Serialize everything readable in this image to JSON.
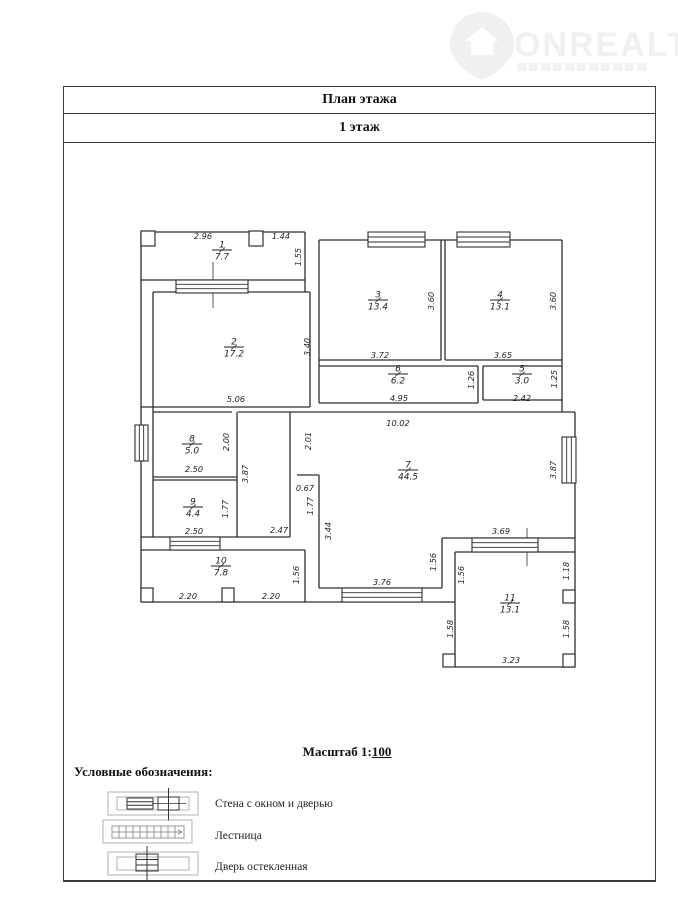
{
  "logo": {
    "brand": "ONREALT",
    "icon": "house-pin-icon"
  },
  "header": {
    "title": "План этажа",
    "subtitle": "1 этаж"
  },
  "scale": {
    "prefix": "Масштаб 1:",
    "value": "100"
  },
  "legend": {
    "title": "Условные обозначения:",
    "items": [
      {
        "symbol": "wall-with-window-and-door",
        "label": "Стена с окном и дверью"
      },
      {
        "symbol": "stairs",
        "label": "Лестница"
      },
      {
        "symbol": "glazed-door",
        "label": "Дверь остекленная"
      }
    ]
  },
  "plan": {
    "rooms": [
      {
        "num": "1",
        "area": "7.7",
        "x": 222,
        "y": 250
      },
      {
        "num": "2",
        "area": "17.2",
        "x": 234,
        "y": 347
      },
      {
        "num": "3",
        "area": "13.4",
        "x": 378,
        "y": 300
      },
      {
        "num": "4",
        "area": "13.1",
        "x": 500,
        "y": 300
      },
      {
        "num": "5",
        "area": "3.0",
        "x": 522,
        "y": 374
      },
      {
        "num": "6",
        "area": "6.2",
        "x": 398,
        "y": 374
      },
      {
        "num": "7",
        "area": "44.5",
        "x": 408,
        "y": 470
      },
      {
        "num": "8",
        "area": "5.0",
        "x": 192,
        "y": 444
      },
      {
        "num": "9",
        "area": "4.4",
        "x": 193,
        "y": 507
      },
      {
        "num": "10",
        "area": "7.8",
        "x": 221,
        "y": 566
      },
      {
        "num": "11",
        "area": "13.1",
        "x": 510,
        "y": 603
      }
    ],
    "dims_h": [
      {
        "v": "2.96",
        "x": 203,
        "y": 236
      },
      {
        "v": "1.44",
        "x": 281,
        "y": 236
      },
      {
        "v": "5.06",
        "x": 236,
        "y": 399
      },
      {
        "v": "3.72",
        "x": 380,
        "y": 355
      },
      {
        "v": "3.65",
        "x": 503,
        "y": 355
      },
      {
        "v": "4.95",
        "x": 399,
        "y": 398
      },
      {
        "v": "2.42",
        "x": 522,
        "y": 398
      },
      {
        "v": "10.02",
        "x": 398,
        "y": 423
      },
      {
        "v": "0.67",
        "x": 305,
        "y": 488
      },
      {
        "v": "2.50",
        "x": 194,
        "y": 469
      },
      {
        "v": "2.50",
        "x": 194,
        "y": 531
      },
      {
        "v": "2.47",
        "x": 279,
        "y": 530
      },
      {
        "v": "3.76",
        "x": 382,
        "y": 582
      },
      {
        "v": "2.20",
        "x": 188,
        "y": 596
      },
      {
        "v": "2.20",
        "x": 271,
        "y": 596
      },
      {
        "v": "3.69",
        "x": 501,
        "y": 531
      },
      {
        "v": "3.23",
        "x": 511,
        "y": 660
      }
    ],
    "dims_v": [
      {
        "v": "1.55",
        "x": 301,
        "y": 257
      },
      {
        "v": "3.40",
        "x": 310,
        "y": 347
      },
      {
        "v": "3.60",
        "x": 434,
        "y": 301
      },
      {
        "v": "3.60",
        "x": 556,
        "y": 301
      },
      {
        "v": "1.26",
        "x": 474,
        "y": 380
      },
      {
        "v": "1.25",
        "x": 557,
        "y": 379
      },
      {
        "v": "2.01",
        "x": 311,
        "y": 441
      },
      {
        "v": "2.00",
        "x": 229,
        "y": 442
      },
      {
        "v": "3.87",
        "x": 248,
        "y": 474
      },
      {
        "v": "3.87",
        "x": 556,
        "y": 470
      },
      {
        "v": "1.77",
        "x": 228,
        "y": 509
      },
      {
        "v": "1.77",
        "x": 313,
        "y": 506
      },
      {
        "v": "3.44",
        "x": 331,
        "y": 531
      },
      {
        "v": "1.56",
        "x": 299,
        "y": 575
      },
      {
        "v": "1.56",
        "x": 436,
        "y": 562
      },
      {
        "v": "1.56",
        "x": 464,
        "y": 575
      },
      {
        "v": "1.18",
        "x": 569,
        "y": 571
      },
      {
        "v": "1.58",
        "x": 453,
        "y": 629
      },
      {
        "v": "1.58",
        "x": 569,
        "y": 629
      }
    ]
  },
  "colors": {
    "wall": "#2e2e2e",
    "border": "#3a3a3a",
    "dim_text": "#1f1f1f",
    "legend_gray": "#b2b2b2",
    "watermark": "#f2f0ee"
  }
}
